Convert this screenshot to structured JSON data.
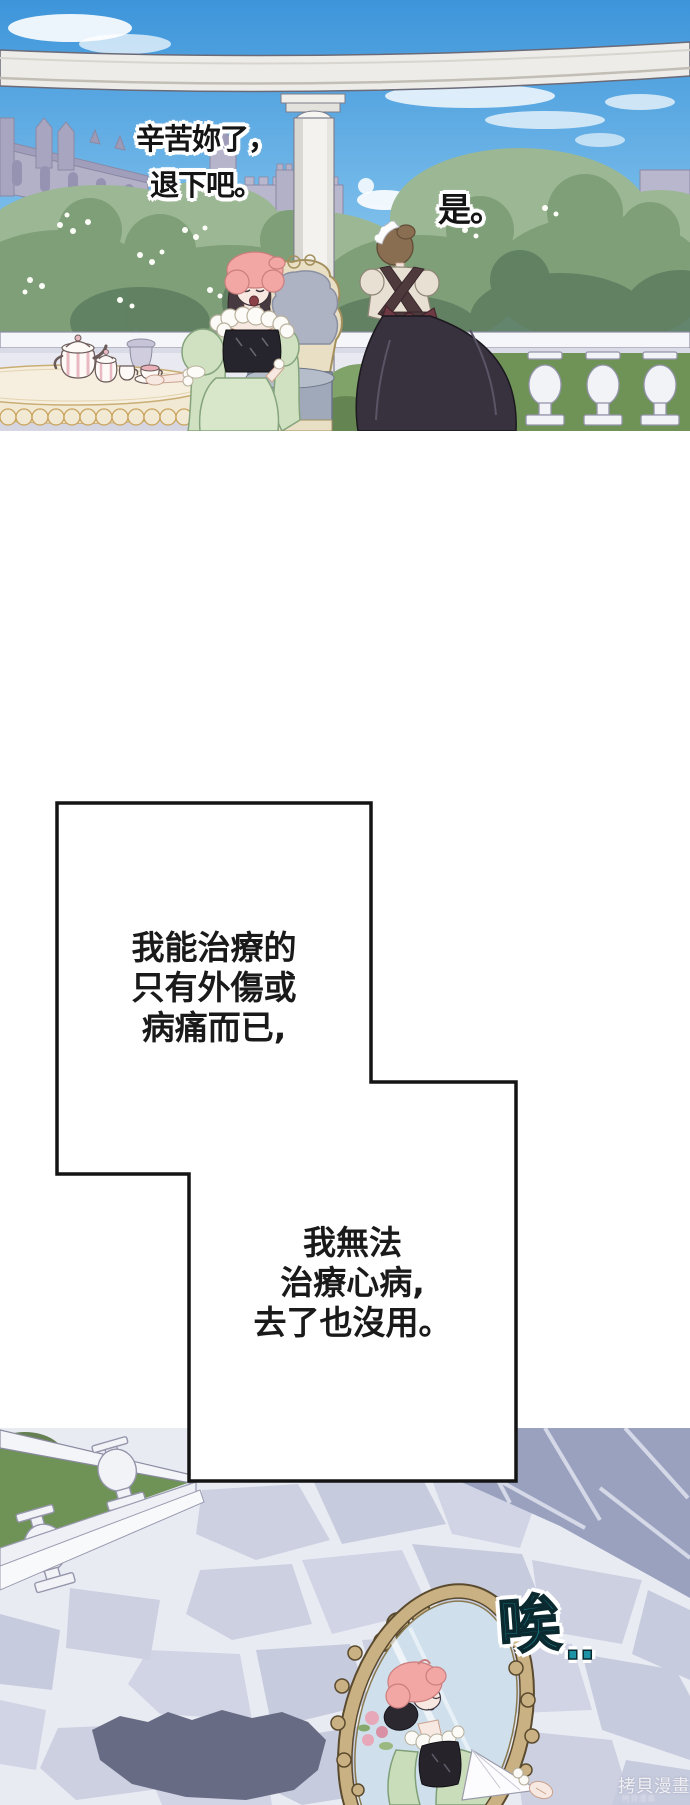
{
  "page": {
    "width": 690,
    "height": 1805
  },
  "panel_top": {
    "bubble_queen": {
      "line1": "辛苦妳了，",
      "line2": "退下吧。"
    },
    "bubble_maid": {
      "text": "是。"
    }
  },
  "speech_box": {
    "part1": {
      "line1": "我能治療的",
      "line2": "只有外傷或",
      "line3": "病痛而已,"
    },
    "part2": {
      "line1": "我無法",
      "line2": "治療心病,",
      "line3": "去了也沒用。"
    }
  },
  "panel_bottom": {
    "sigh": "唉",
    "sigh_dots": "..",
    "watermark": "拷貝漫畫"
  },
  "colors": {
    "panel_border": "#141414",
    "sky_top": "#3d95da",
    "sky_bottom": "#b9def5",
    "foliage": "#7e9f78",
    "lawn": "#6f9257",
    "sigh_teal": "#1d93a5",
    "mirror_frame": "#cab183",
    "pavement_light": "#cdd1e2",
    "pavement_dark": "#99a1bf",
    "dress_mint": "#cfe1c0",
    "hair_pink": "#f3a7a4",
    "maid_skirt": "#37323d",
    "watermark_color": "#ffffff"
  }
}
